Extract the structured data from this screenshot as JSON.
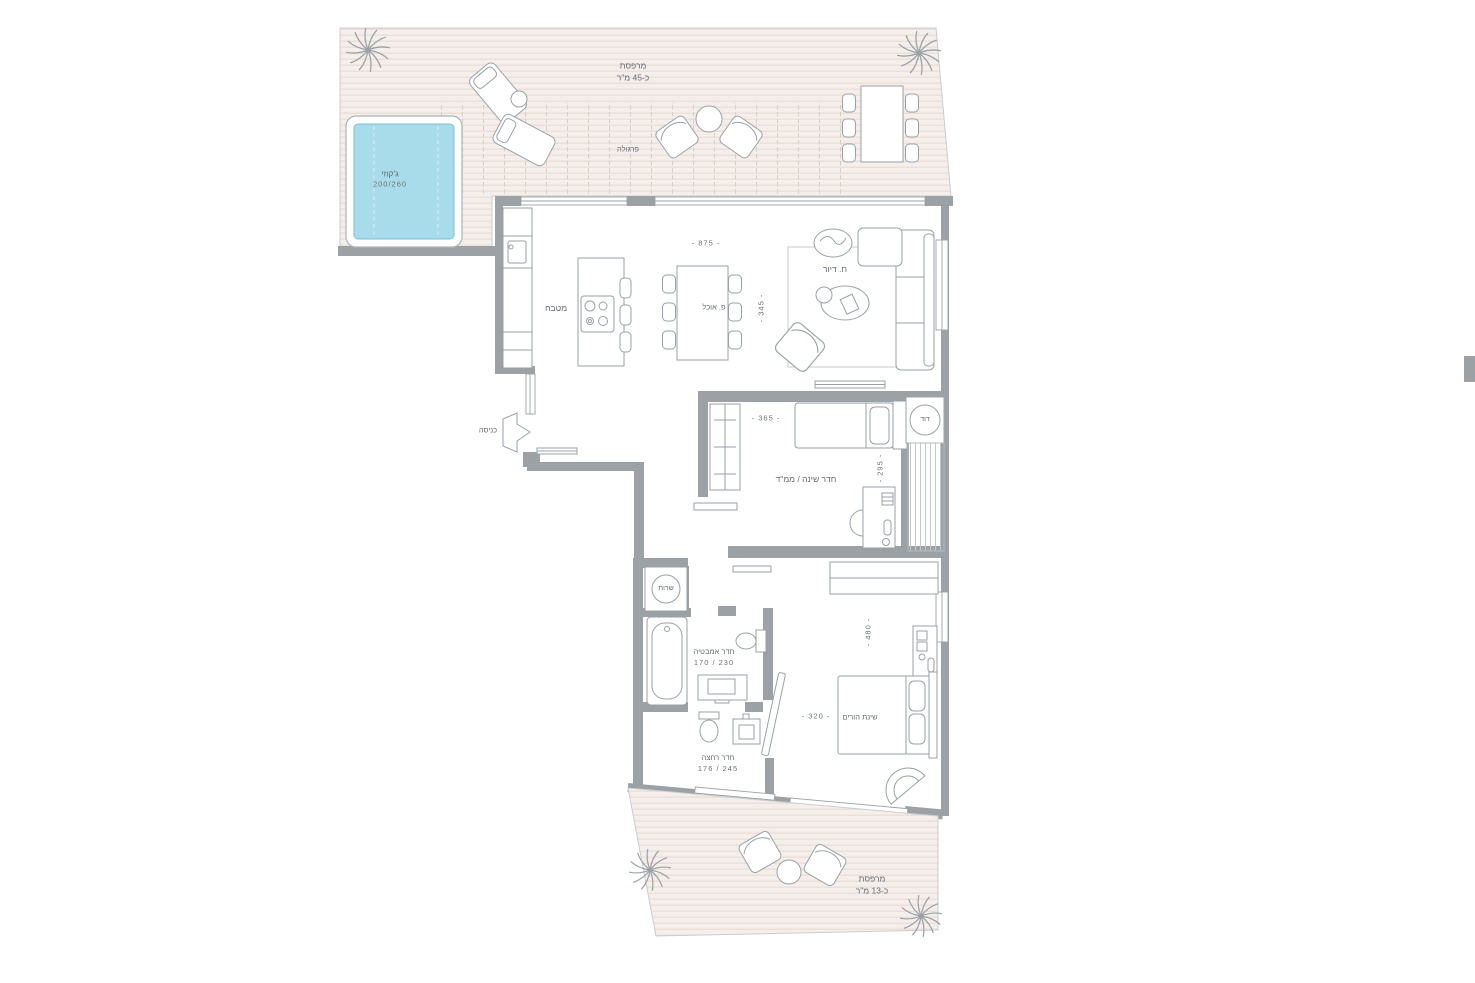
{
  "labels": {
    "terrace_top_1": "מרפסת",
    "terrace_top_2": "כ-45 מ\"ר",
    "pergola": "פרגולה",
    "jacuzzi_1": "ג'קוזי",
    "jacuzzi_2": "200/260",
    "kitchen": "מטבח",
    "dining": "פ. אוכל",
    "living": "ח. דיור",
    "entrance": "כניסה",
    "bedroom": "חדר שינה / ממ\"ד",
    "boiler": "דוד",
    "service": "שרות",
    "bathroom_1": "חדר אמבטיה",
    "bathroom_2": "170 / 230",
    "shower_1": "חדר רחצה",
    "shower_2": "176 / 245",
    "master": "שינת הורים",
    "terrace_bottom_1": "מרפסת",
    "terrace_bottom_2": "כ-13 מ\"ר"
  },
  "dimensions": {
    "dining_width": "- 875 -",
    "living_depth": "- 345 -",
    "bedroom_width": "- 365 -",
    "bedroom_depth": "- 295 -",
    "master_width": "- 320 -",
    "master_depth": "- 480 -"
  },
  "colors": {
    "wall": "#9ba1a5",
    "deck": "#f5efec",
    "deck_stripe": "#e9d9d2",
    "pool": "#a9dcea",
    "furniture_outline": "#99a1a7",
    "text": "#646b76"
  }
}
